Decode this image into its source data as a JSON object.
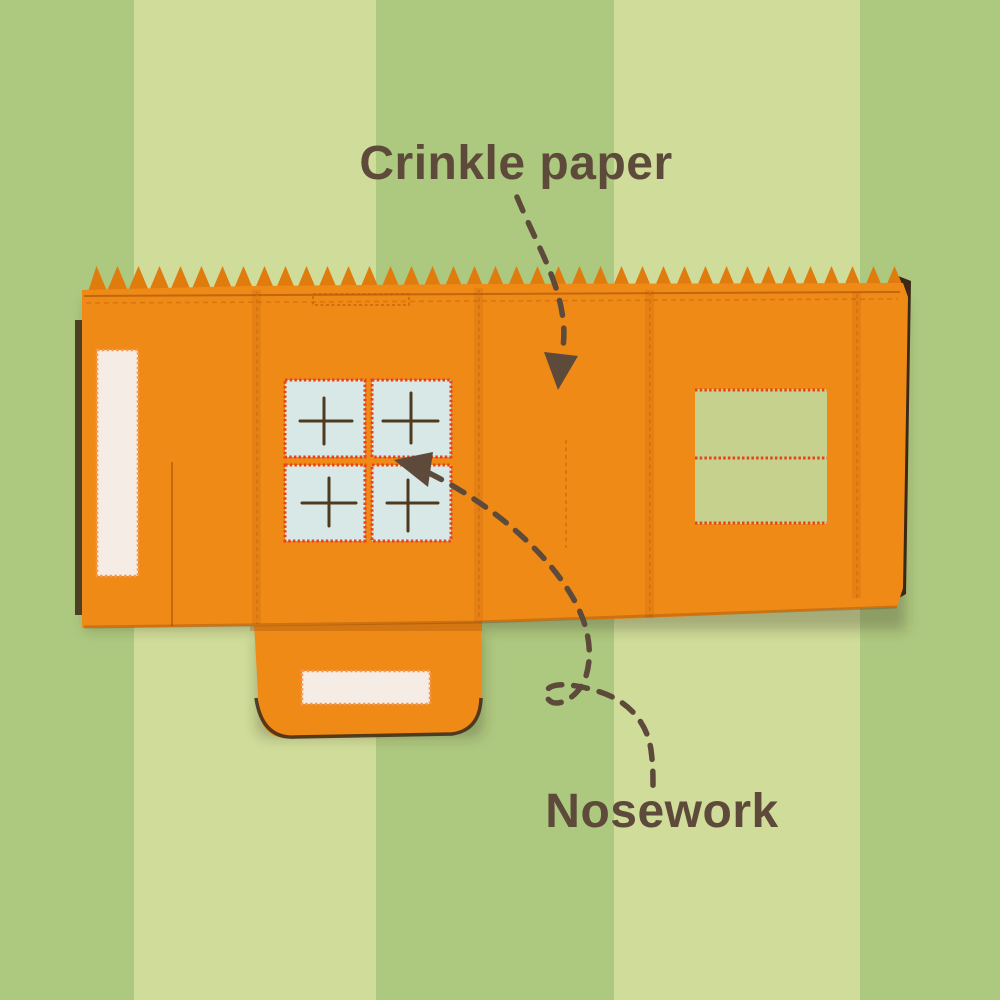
{
  "annotations": {
    "crinkle_paper": {
      "label": "Crinkle paper"
    },
    "nosework": {
      "label": "Nosework"
    }
  },
  "icons": {
    "crinkle_arrow": "dashed-arrow-down",
    "nosework_arrow": "dashed-looping-arrow-up-left"
  },
  "colors": {
    "stripe-dark": "#adc87f",
    "stripe-light": "#cfdc9a",
    "fabric-orange": "#ef8a17",
    "fabric-orange-deep": "#e07c0e",
    "backing-brown": "#3c2817",
    "patch-cream": "#f5ece6",
    "stitch-peach": "#f49a54",
    "pane-blue": "#d7e8e6",
    "stitch-red": "#e8421a",
    "patch-green": "#c5d18d",
    "slit-brown": "#4d3a1f",
    "seam-orange": "#d4720a",
    "annotation-brown": "#5d4a3a"
  }
}
